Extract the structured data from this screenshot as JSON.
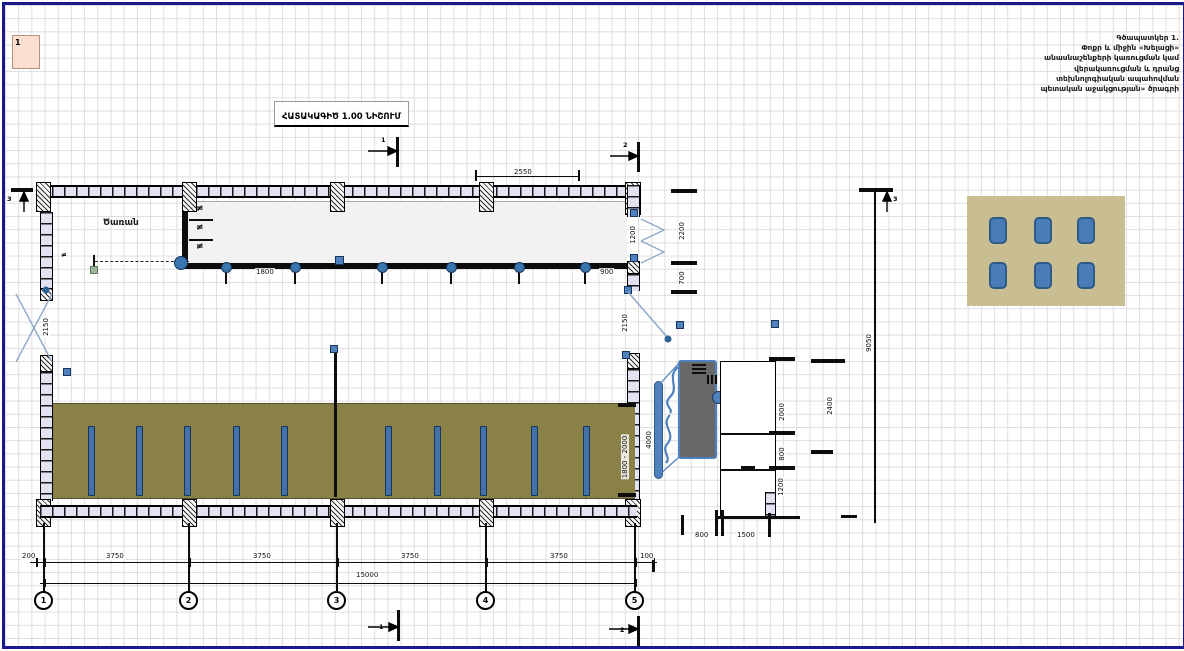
{
  "sheet": {
    "corner_label": "1"
  },
  "title": {
    "text": "ՀԱՏԱԿԱԳԻԾ 1.00 ՆԻՇՈՒՄ"
  },
  "program_note": {
    "line1": "Գծապատկեր 1.",
    "line2": "Փոքր և միջին «Խելացի»",
    "line3": "անասնաշենքերի կառուցման կամ",
    "line4": "վերակառուցման և դրանց",
    "line5": "տեխնոլոգիական ապահովման",
    "line6": "պետական աջակցության» ծրագրի"
  },
  "plan": {
    "room_label": "Ծառան",
    "feeder_symbol": "≠"
  },
  "dims": {
    "top_width": "2550",
    "feed_spacing": "1800",
    "right_gap": "900",
    "door_top_right": "1200",
    "right_upper": "2200",
    "right_lower": "700",
    "left_door": "2150",
    "right_door": "2150",
    "stall_length": "1800 - 2000",
    "stall_row_width": "4000",
    "annex_room1": "2000",
    "annex_room2": "800",
    "annex_room3": "1200",
    "annex_width": "2400",
    "overall_height": "9050",
    "annex_bottom1": "800",
    "annex_bottom2": "1500",
    "bottom_left_offset": "200",
    "bay1": "3750",
    "bay2": "3750",
    "bay3": "3750",
    "bay4": "3750",
    "bottom_right_offset": "100",
    "total_length": "15000"
  },
  "axes": {
    "a1": "1",
    "a2": "2",
    "a3": "3",
    "a4": "4",
    "a5": "5"
  },
  "sections": {
    "s1": "1",
    "s2": "2",
    "s3": "3"
  },
  "colors": {
    "accent_blue": "#4f81bd",
    "olive": "#8a8147",
    "tan": "#c9bd92",
    "navy_border": "#1a1a8c",
    "wall_fill": "#e2e2f2"
  }
}
